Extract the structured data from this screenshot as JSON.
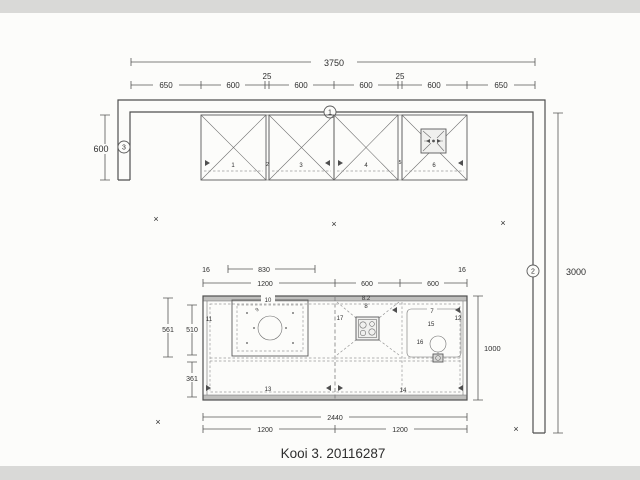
{
  "title": "Kooi 3. 20116287",
  "symbols": {
    "x_mark": "×"
  },
  "markers": {
    "wall_top": "1",
    "wall_right": "2",
    "wall_left": "3"
  },
  "dims": {
    "top": {
      "overall": "3750",
      "gap1": "25",
      "gap2": "25",
      "segments": [
        "650",
        "600",
        "600",
        "600",
        "600",
        "650"
      ]
    },
    "left_wall": "600",
    "right_wall": "3000",
    "island_top": {
      "edge_left": "16",
      "unit_width": "830",
      "edge_right": "16",
      "row": [
        "1200",
        "600",
        "600"
      ]
    },
    "island_left": {
      "outer": "561",
      "upper": "510",
      "lower": "361"
    },
    "island_right": "1000",
    "island_bottom": {
      "overall": "2440",
      "row": [
        "1200",
        "1200"
      ]
    }
  },
  "cabinets": {
    "numbers": [
      "1",
      "2",
      "3",
      "4",
      "5",
      "6"
    ]
  },
  "island": {
    "items": {
      "left_edge": "11",
      "sink_unit": "10",
      "sink_note": "9",
      "mid_divider": "17",
      "hob_note": "8.2",
      "hob": "8",
      "right_unit": "7",
      "tap": "15",
      "bowl": "16",
      "right_divider": "12",
      "base_left": "13",
      "base_right": "14"
    }
  }
}
